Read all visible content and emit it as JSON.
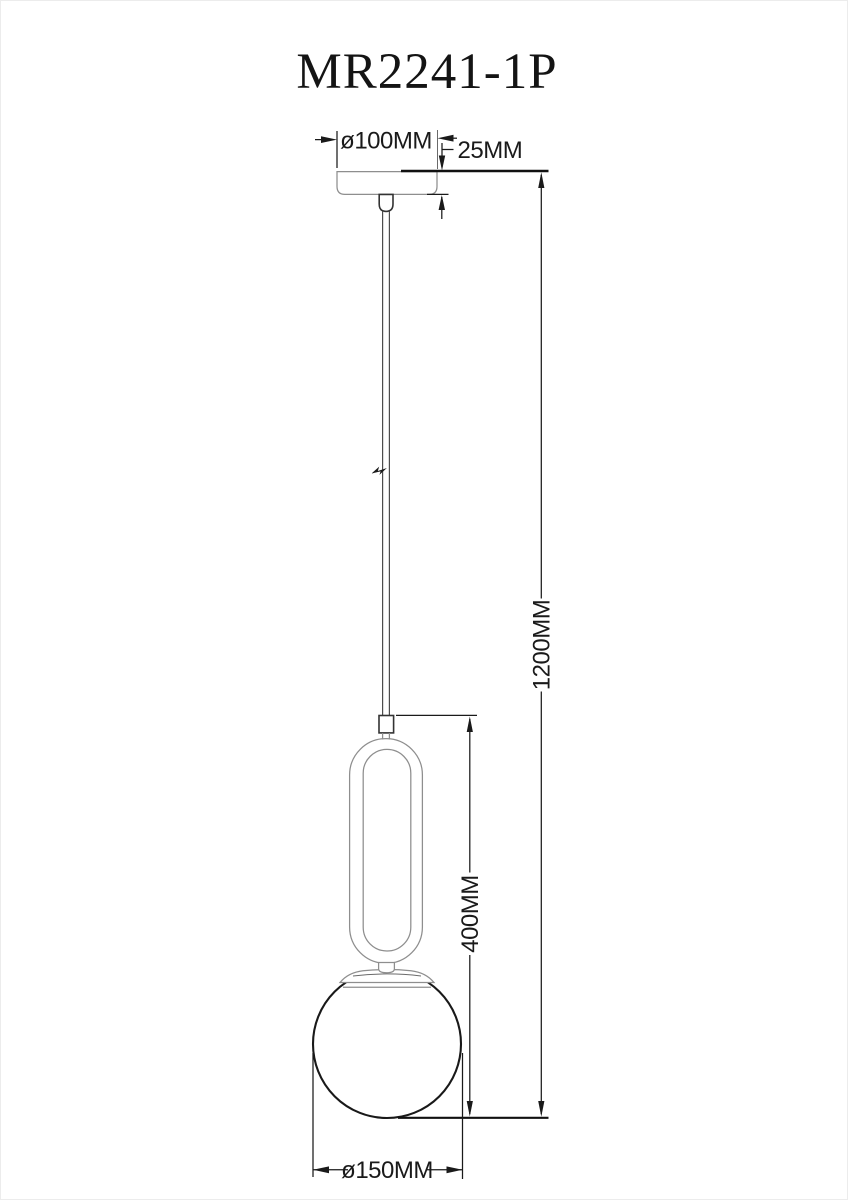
{
  "page": {
    "background": "#ffffff",
    "border": "#ececec"
  },
  "drawing": {
    "model": "MR2241-1P",
    "type": "pendant-lamp-dimension-drawing",
    "dimensions": {
      "canopy_diameter": "ø100MM",
      "canopy_height": "25MM",
      "overall_drop": "1200MM",
      "fixture_height": "400MM",
      "globe_diameter": "ø150MM"
    },
    "colors": {
      "object_line": "#8e8e8e",
      "dark_object_line": "#333333",
      "dimension_line": "#1a1a1a",
      "heavy_line": "#111111",
      "text": "#141414"
    }
  }
}
